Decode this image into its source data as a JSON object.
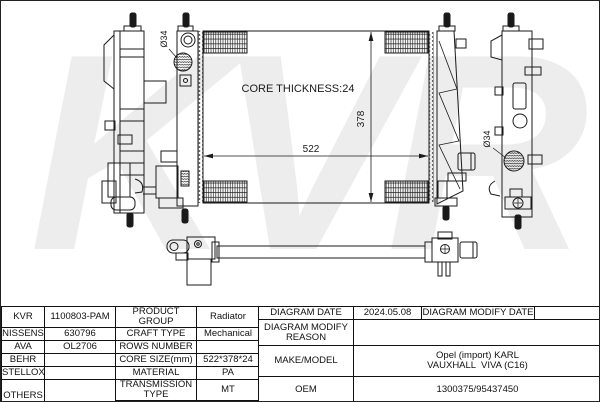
{
  "watermark": "KVR",
  "drawing": {
    "core_thickness_label": "CORE THICKNESS:24",
    "core_width_dim": "522",
    "core_height_dim": "378",
    "left_port_dia": "Ø34",
    "right_port_dia": "Ø34"
  },
  "table": {
    "left": {
      "rows": [
        {
          "brand": "KVR",
          "code": "1100803-PAM",
          "label": "PRODUCT GROUP",
          "value": "Radiator"
        },
        {
          "brand": "NISSENS",
          "code": "630796",
          "label": "CRAFT TYPE",
          "value": "Mechanical"
        },
        {
          "brand": "AVA",
          "code": "OL2706",
          "label": "ROWS NUMBER",
          "value": ""
        },
        {
          "brand": "BEHR",
          "code": "",
          "label": "CORE SIZE(mm)",
          "value": "522*378*24"
        },
        {
          "brand": "STELLOX",
          "code": "",
          "label": "MATERIAL",
          "value": "PA"
        },
        {
          "brand": "OTHERS",
          "code": "",
          "label": "TRANSMISSION TYPE",
          "value": "MT"
        },
        {
          "label": "SUPPLEMENTARY",
          "value": ""
        }
      ]
    },
    "right": {
      "diagram_date_label": "DIAGRAM DATE",
      "diagram_date_value": "2024.05.08",
      "modify_date_label": "DIAGRAM MODIFY DATE",
      "modify_date_value": "",
      "modify_reason_label": "DIAGRAM MODIFY REASON",
      "modify_reason_value": "",
      "make_model_label": "MAKE/MODEL",
      "make_model_lines": [
        "Opel (import) KARL",
        "VAUXHALL  VIVA (C16)"
      ],
      "oem_label": "OEM",
      "oem_value": "1300375/95437450"
    }
  }
}
